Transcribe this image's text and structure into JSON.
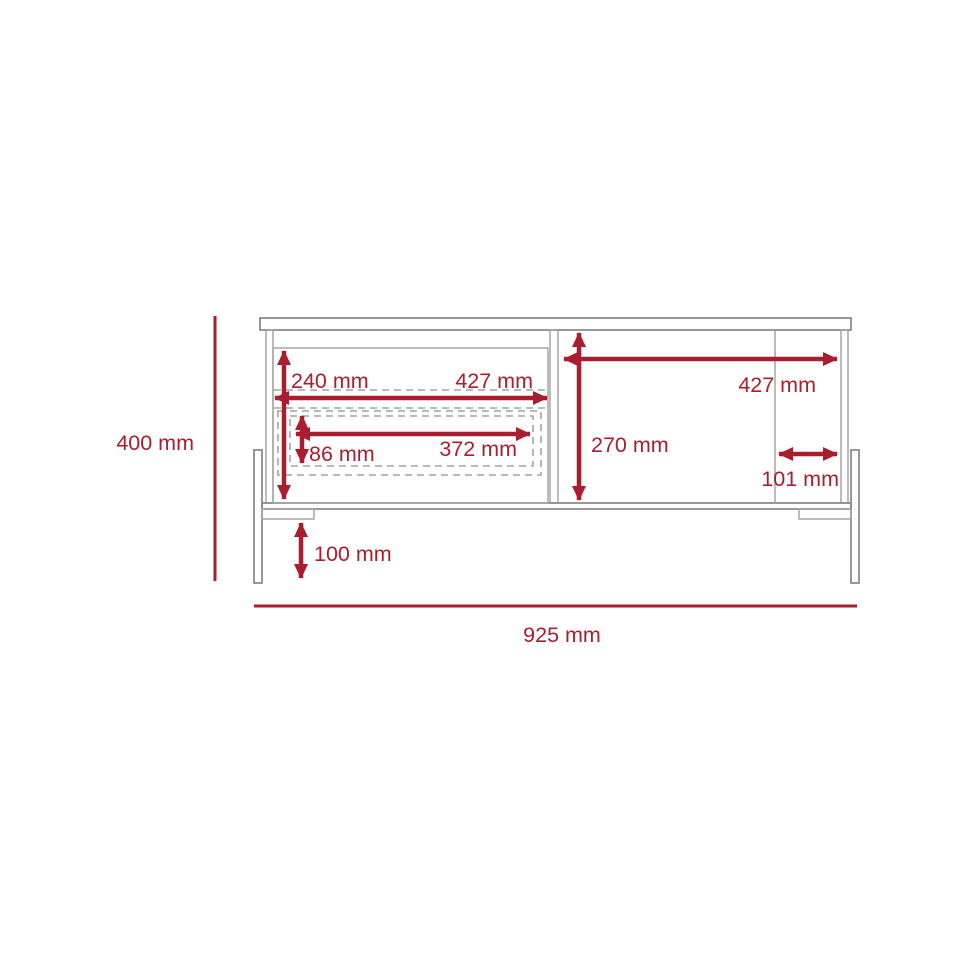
{
  "diagram": {
    "kind": "furniture-dimension-drawing",
    "unit": "mm",
    "colors": {
      "dimension_red": "#a81e2e",
      "outline_gray": "#8c8c8c",
      "panel_gray": "#a6a6a6",
      "dash_gray": "#a3a3a3"
    },
    "dimensions": {
      "overall_height": "400 mm",
      "overall_width": "925 mm",
      "drawer_front_height": "240 mm",
      "left_compartment_width": "427 mm",
      "drawer_inner_height": "86 mm",
      "drawer_inner_width": "372 mm",
      "right_compartment_height": "270 mm",
      "right_compartment_width": "427 mm",
      "right_section_inset": "101 mm",
      "leg_clearance_height": "100 mm"
    }
  }
}
